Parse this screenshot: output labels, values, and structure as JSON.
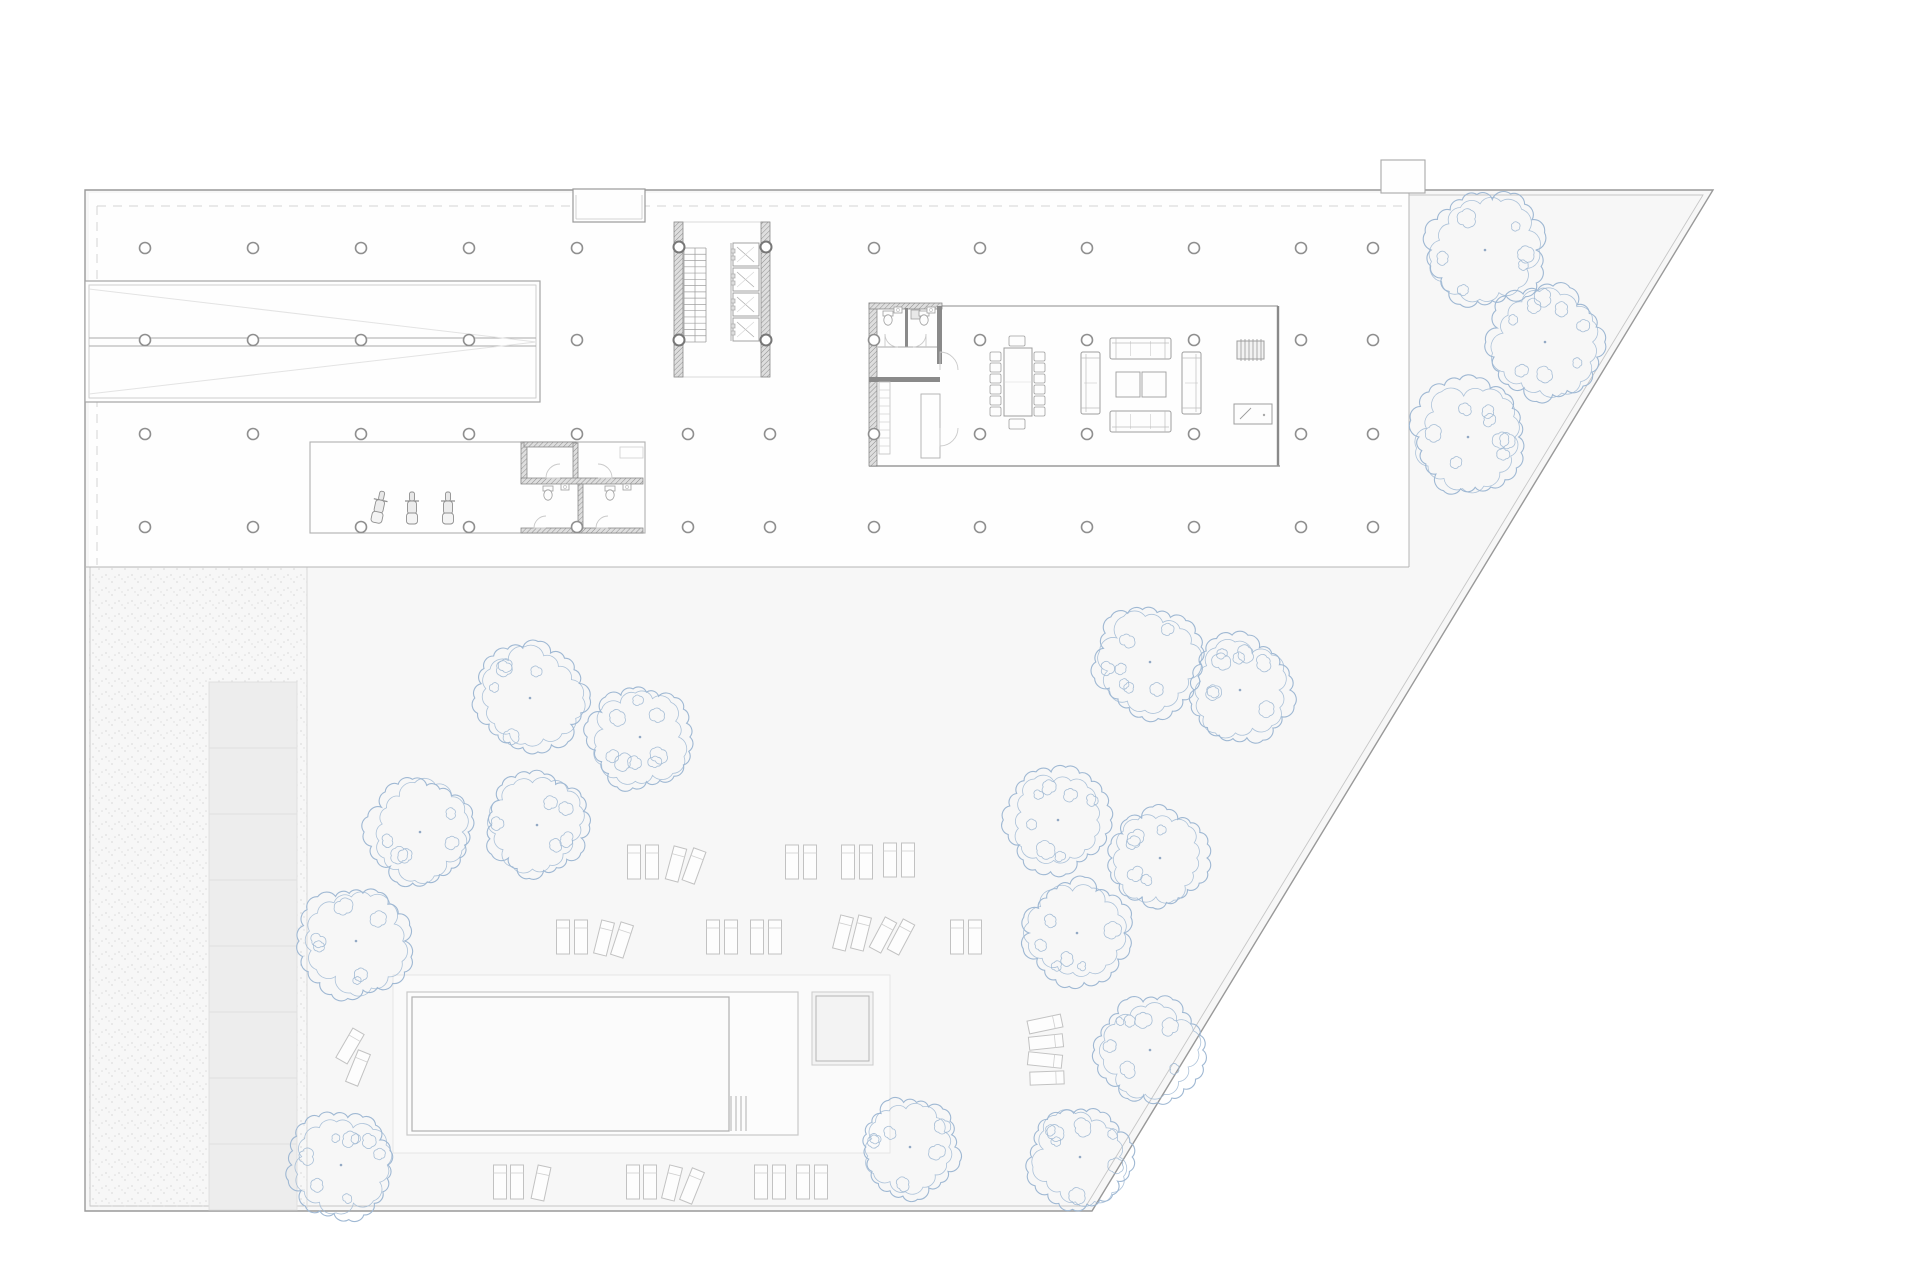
{
  "canvas": {
    "w": 1920,
    "h": 1280,
    "bg": "#ffffff"
  },
  "palette": {
    "site_fill": "#f7f7f7",
    "building_fill": "#fefefe",
    "boundary": "#999999",
    "boundary_inner": "#c6c6c6",
    "edge": "#b5b5b5",
    "line": "#a8a8a8",
    "line_light": "#cfcfcf",
    "line_faint": "#e3e3e3",
    "wall_dark": "#8a8a8a",
    "hatch_bg": "#dedede",
    "hatch_line": "#8f8f8f",
    "dash": "#d4d4d4",
    "column_stroke": "#8f8f8f",
    "tree": "#9fb8d3",
    "tree_dot": "#93a9c4",
    "terrace_fill": "#fafafa",
    "terrace_stroke": "#e6e6e6",
    "pool_stroke": "#c9c9c9",
    "pool_fill": "#fcfcfc",
    "water_stroke": "#b0b0b0",
    "water_fill": "#fbfbfb",
    "pav_fill": "#f3f3f3",
    "pav_stroke": "#cfcfcf",
    "pav_inner": "#b5b5b5",
    "band_fill": "#ededed",
    "band_stroke": "#e0e0e0",
    "furn": "#9e9e9e",
    "furn_light": "#c2c2c2",
    "door": "#c9c9c9",
    "stipple": "#dcdcdc"
  },
  "site": {
    "outer": [
      [
        85,
        190
      ],
      [
        1713,
        190
      ],
      [
        1092,
        1211
      ],
      [
        85,
        1211
      ]
    ],
    "inner": [
      [
        90,
        195
      ],
      [
        1703,
        195
      ],
      [
        1086,
        1206
      ],
      [
        90,
        1206
      ]
    ]
  },
  "building": {
    "x": 89,
    "y": 193,
    "w": 1320,
    "h": 374,
    "notch": {
      "x1": 573,
      "x2": 645,
      "y1": 193,
      "y2": 222
    },
    "bump": {
      "x": 1381,
      "y": 160,
      "w": 44,
      "h": 33
    },
    "dash_h": {
      "y": 206,
      "x1": 97,
      "x2": 1407
    },
    "dash_v": {
      "x": 97,
      "y1": 206,
      "y2": 565
    }
  },
  "ramp": {
    "outer": [
      85,
      281,
      455,
      121
    ],
    "inner": [
      89,
      285,
      447,
      113
    ],
    "mid_y1": 338,
    "mid_y2": 346,
    "apex_x": 536,
    "apex_y": 342
  },
  "columns": {
    "r": 5.5,
    "rows": [
      248,
      340,
      434,
      527
    ],
    "xs": [
      145,
      253,
      361,
      469,
      577,
      874,
      980,
      1087,
      1194,
      1301,
      1373
    ],
    "extra": [
      [
        688,
        434
      ],
      [
        770,
        434
      ],
      [
        688,
        527
      ],
      [
        770,
        527
      ]
    ],
    "core": [
      [
        679,
        247
      ],
      [
        766,
        247
      ],
      [
        679,
        340
      ],
      [
        766,
        340
      ]
    ]
  },
  "core": {
    "wall_l": [
      674,
      222,
      9,
      155
    ],
    "wall_r": [
      761,
      222,
      9,
      155
    ],
    "top_y": 222,
    "bot_y": 377,
    "x1": 674,
    "x2": 770,
    "stair": {
      "x1": 684,
      "x2": 706,
      "y1": 248,
      "y2": 342,
      "steps": 15,
      "mid_x": 695
    },
    "shaft_x": 731,
    "cab_x": 733,
    "cab_w": 26,
    "cab_h": 23,
    "cab_ys": [
      243,
      268,
      293,
      318
    ]
  },
  "garage": {
    "rect": [
      310,
      442,
      335,
      91
    ],
    "walls": [
      [
        521,
        442,
        6,
        41
      ],
      [
        524,
        442,
        52,
        5
      ],
      [
        573,
        443,
        5,
        36
      ],
      [
        521,
        478,
        122,
        6
      ],
      [
        578,
        484,
        5,
        44
      ],
      [
        521,
        528,
        122,
        5
      ]
    ],
    "counter": [
      620,
      447,
      23,
      11
    ],
    "scooters": [
      [
        379,
        508,
        12
      ],
      [
        412,
        509,
        0
      ],
      [
        448,
        509,
        0
      ]
    ],
    "wcs": [
      [
        548,
        490
      ],
      [
        610,
        490
      ]
    ],
    "sinks": [
      [
        565,
        487
      ],
      [
        627,
        487
      ]
    ]
  },
  "room": {
    "x": 869,
    "y": 303,
    "w": 411,
    "h": 163,
    "wall_l": [
      869,
      303,
      8,
      163
    ],
    "wall_top": [
      869,
      303,
      73,
      6
    ],
    "wall_right_bath": [
      937,
      306,
      5,
      58
    ],
    "divider": [
      905,
      308,
      3,
      39
    ],
    "sill_y": 347,
    "sill_x1": 878,
    "sill_x2": 937,
    "wall2": [
      869,
      377,
      71,
      5
    ],
    "top_line": [
      942,
      306,
      1278,
      306
    ],
    "right_wall": [
      1278,
      306,
      1278,
      466
    ],
    "bottom_line": [
      869,
      466,
      1280,
      466
    ],
    "closet": [
      921,
      394,
      19,
      64
    ],
    "ladder": [
      879,
      382,
      11,
      72
    ],
    "shower": [
      911,
      310,
      9,
      9
    ],
    "wcs": [
      [
        888,
        315
      ],
      [
        924,
        315
      ]
    ],
    "sinks": [
      [
        898,
        310
      ],
      [
        931,
        310
      ]
    ],
    "table": {
      "x": 1004,
      "y": 348,
      "w": 28,
      "h": 68,
      "chairs_l_x": 990,
      "chairs_r_x": 1034,
      "chair_ys": [
        352,
        363,
        374,
        385,
        396,
        407
      ],
      "chair_top": [
        1009,
        336
      ],
      "chair_bot": [
        1009,
        419
      ],
      "cw": 11,
      "ch": 9
    },
    "sofas": {
      "top": [
        1110,
        338,
        61,
        21
      ],
      "bottom": [
        1110,
        411,
        61,
        21
      ],
      "left": [
        1081,
        352,
        19,
        62
      ],
      "right": [
        1182,
        352,
        19,
        62
      ],
      "tables": [
        [
          1116,
          372,
          24,
          25
        ],
        [
          1142,
          372,
          24,
          25
        ]
      ]
    },
    "shelf": [
      1237,
      341,
      27,
      18
    ],
    "desk": [
      1234,
      404,
      38,
      20
    ]
  },
  "doors": [
    "M898,347 A13,13 0 0 1 885,334 L885,347",
    "M913,347 A13,13 0 0 0 926,334 L926,347",
    "M958,370 A18,18 0 0 0 940,352 L940,370",
    "M958,428 A18,18 0 0 1 940,446 L940,428",
    "M560,464 A14,14 0 0 0 546,478 L560,478",
    "M598,464 A14,14 0 0 1 612,478 L598,478",
    "M546,516 A12,12 0 0 0 534,528 L546,528",
    "M608,516 A12,12 0 0 0 596,528 L608,528"
  ],
  "landscape": {
    "bottom_y": 567,
    "strip": {
      "x": 89,
      "y": 567,
      "w": 218,
      "h": 644
    },
    "strip_edge_x": 307,
    "band": {
      "x": 209,
      "w": 88,
      "y0": 682,
      "seg": 66,
      "n": 8
    },
    "terrace": [
      393,
      975,
      497,
      178
    ],
    "pool_outer": [
      407,
      992,
      391,
      143
    ],
    "water": [
      412,
      997,
      317,
      134
    ],
    "steps_x": [
      731,
      736,
      741,
      746
    ],
    "steps_y1": 1096,
    "steps_y2": 1131,
    "pavilion_outer": [
      812,
      992,
      61,
      73
    ],
    "pavilion_inner": [
      816,
      996,
      53,
      65
    ]
  },
  "sunbeds": {
    "w": 13,
    "h": 34,
    "items": [
      [
        634,
        862,
        0
      ],
      [
        652,
        862,
        0
      ],
      [
        676,
        864,
        15
      ],
      [
        694,
        866,
        20
      ],
      [
        792,
        862,
        0
      ],
      [
        810,
        862,
        0
      ],
      [
        848,
        862,
        0
      ],
      [
        866,
        862,
        0
      ],
      [
        890,
        860,
        0
      ],
      [
        908,
        860,
        0
      ],
      [
        563,
        937,
        0
      ],
      [
        581,
        937,
        0
      ],
      [
        604,
        938,
        14
      ],
      [
        622,
        940,
        18
      ],
      [
        713,
        937,
        0
      ],
      [
        731,
        937,
        0
      ],
      [
        757,
        937,
        0
      ],
      [
        775,
        937,
        0
      ],
      [
        843,
        933,
        14
      ],
      [
        861,
        933,
        14
      ],
      [
        883,
        935,
        28
      ],
      [
        901,
        937,
        28
      ],
      [
        957,
        937,
        0
      ],
      [
        975,
        937,
        0
      ],
      [
        500,
        1182,
        0
      ],
      [
        517,
        1182,
        0
      ],
      [
        541,
        1183,
        12
      ],
      [
        633,
        1182,
        0
      ],
      [
        650,
        1182,
        0
      ],
      [
        672,
        1183,
        14
      ],
      [
        692,
        1186,
        22
      ],
      [
        761,
        1182,
        0
      ],
      [
        779,
        1182,
        0
      ],
      [
        803,
        1182,
        0
      ],
      [
        821,
        1182,
        0
      ],
      [
        350,
        1046,
        30
      ],
      [
        358,
        1068,
        22
      ],
      [
        1045,
        1024,
        78
      ],
      [
        1046,
        1042,
        84
      ],
      [
        1045,
        1060,
        96
      ],
      [
        1047,
        1078,
        88
      ]
    ]
  },
  "trees": [
    [
      1485,
      250,
      56
    ],
    [
      1545,
      342,
      55
    ],
    [
      1468,
      437,
      54
    ],
    [
      530,
      698,
      54
    ],
    [
      640,
      737,
      50
    ],
    [
      537,
      825,
      49
    ],
    [
      420,
      832,
      51
    ],
    [
      356,
      941,
      54
    ],
    [
      341,
      1165,
      51
    ],
    [
      1150,
      662,
      54
    ],
    [
      1240,
      690,
      51
    ],
    [
      1058,
      820,
      50
    ],
    [
      1160,
      858,
      47
    ],
    [
      1077,
      933,
      51
    ],
    [
      1150,
      1050,
      51
    ],
    [
      910,
      1147,
      48
    ],
    [
      1080,
      1157,
      49
    ]
  ]
}
